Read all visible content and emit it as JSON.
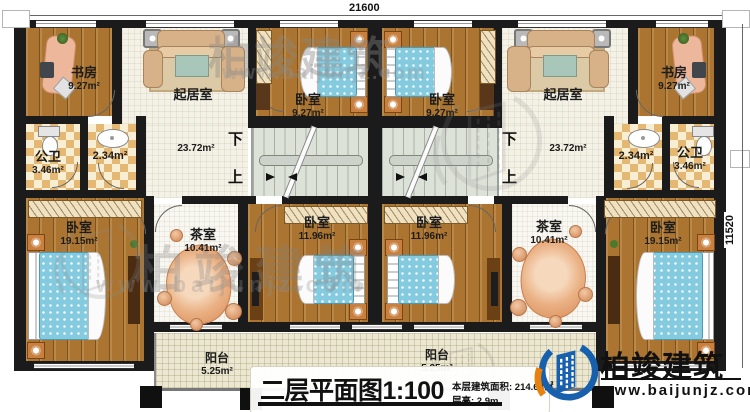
{
  "dimensions": {
    "top": "21600",
    "right": "11520"
  },
  "rooms": {
    "study": {
      "name": "书房",
      "area": "9.27m²"
    },
    "living": {
      "name": "起居室",
      "area": "23.72m²"
    },
    "bedroom_top": {
      "name": "卧室",
      "area": "9.27m²"
    },
    "bath": {
      "name": "公卫",
      "area": "3.46m²"
    },
    "wash": {
      "area": "2.34m²"
    },
    "bedroom_large": {
      "name": "卧室",
      "area": "19.15m²"
    },
    "tea": {
      "name": "茶室",
      "area": "10.41m²"
    },
    "bedroom_mid": {
      "name": "卧室",
      "area": "11.96m²"
    },
    "balcony": {
      "name": "阳台",
      "area": "5.25m²"
    }
  },
  "stairs": {
    "down": "下",
    "up": "上"
  },
  "title_block": {
    "title": "二层平面图1:100",
    "area_text": "本层建筑面积: 214.64㎡",
    "height_text": "层高: 2.9m"
  },
  "logo": {
    "brand": "柏竣建筑",
    "website": "www.baijunjz.com"
  },
  "watermark": {
    "brand": "柏竣建筑",
    "website": "www.baijunjz.com"
  },
  "colors": {
    "wall": "#1b1b1b",
    "wood_floor": "#ab7531",
    "bed": "#85cbe0",
    "stair": "#dde2d9",
    "logo_blue": "#1660ad",
    "logo_orange": "#e8820c"
  }
}
